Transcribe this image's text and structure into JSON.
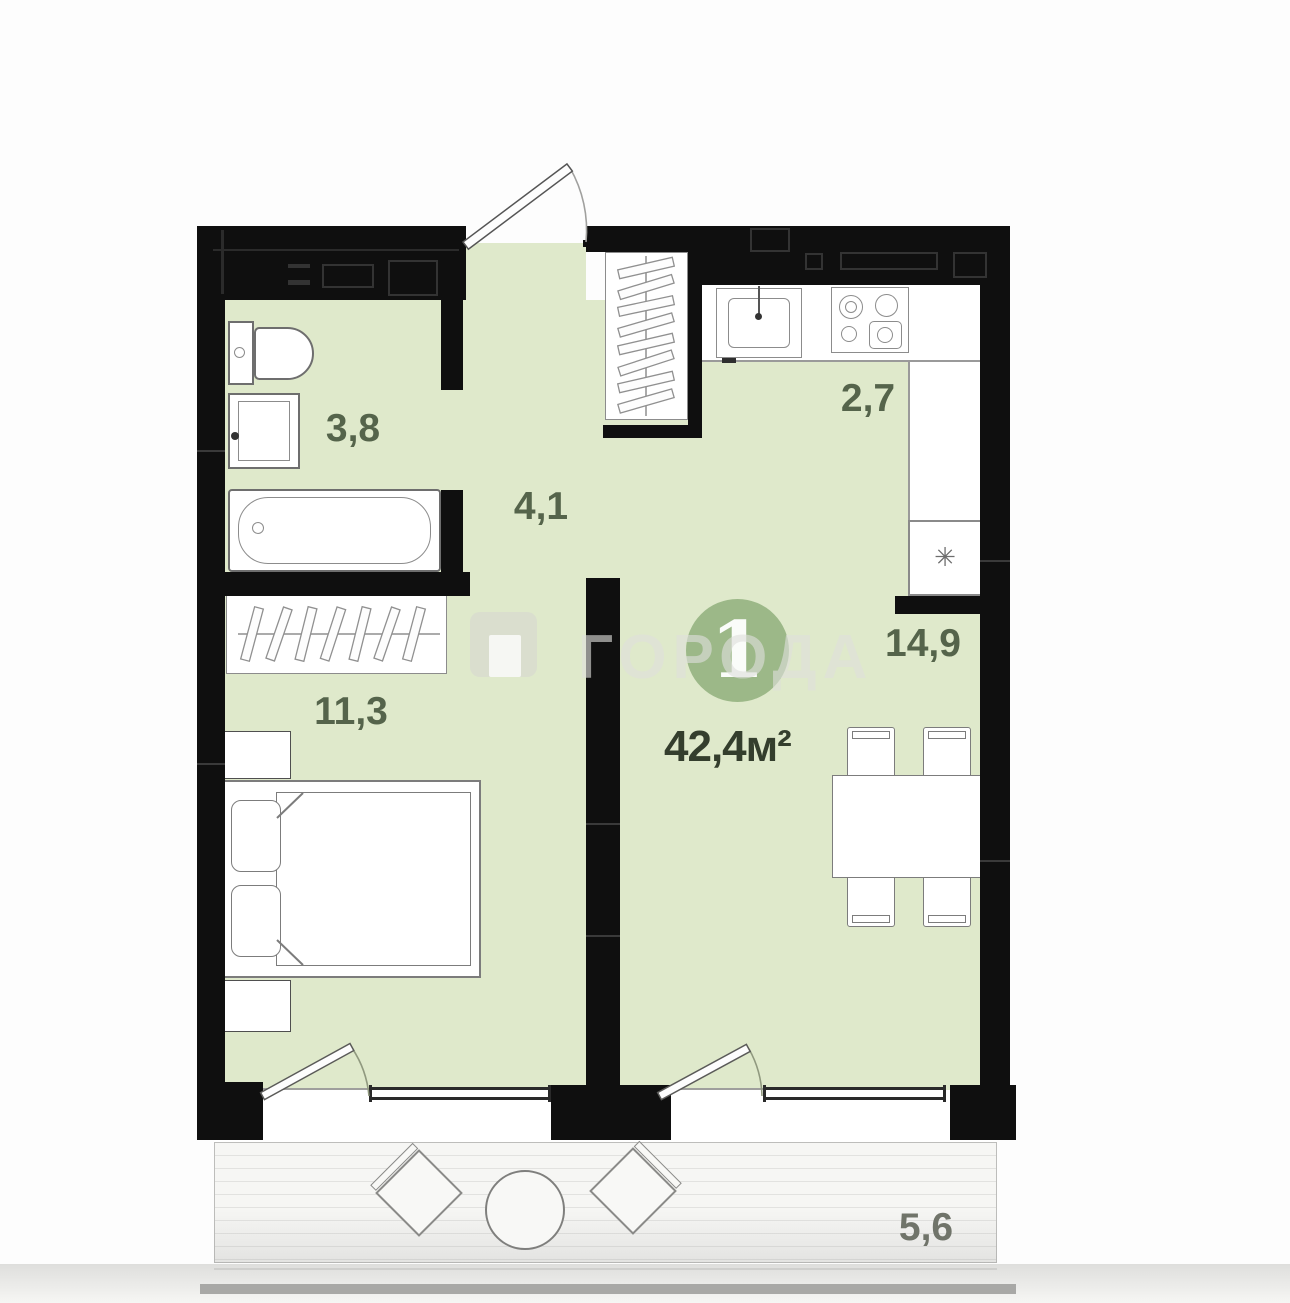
{
  "plan": {
    "apartment_badge": {
      "number": "1"
    },
    "total_area": "42,4м²",
    "rooms": [
      {
        "id": "bathroom",
        "area": "3,8"
      },
      {
        "id": "hallway",
        "area": "4,1"
      },
      {
        "id": "kitchen",
        "area": "2,7"
      },
      {
        "id": "living-room",
        "area": "14,9"
      },
      {
        "id": "bedroom",
        "area": "11,3"
      },
      {
        "id": "balcony",
        "area": "5,6"
      }
    ],
    "watermark": {
      "text": "ГОРОДА"
    },
    "icons": {
      "fridge_snowflake": "✳"
    },
    "colors": {
      "wall": "#0f0f0f",
      "floor": "#dfe9cb",
      "badge": "#9cb888",
      "room_label": "#55644b",
      "balcony_label": "#70746a",
      "watermark": "#dfdfdb"
    }
  }
}
